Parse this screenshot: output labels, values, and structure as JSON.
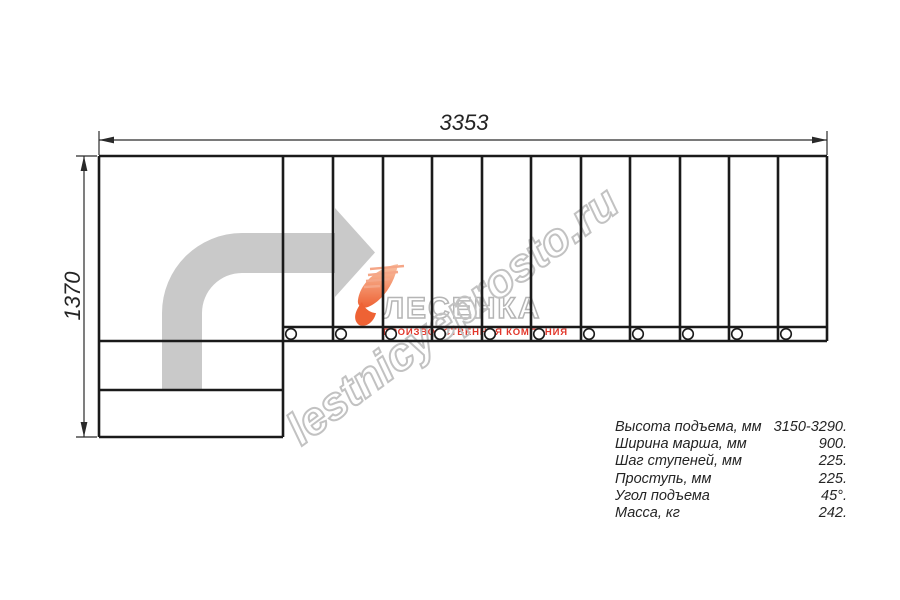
{
  "dimensions": {
    "top_label": "3353",
    "left_label": "1370"
  },
  "specs": {
    "rows": [
      {
        "label": "Высота подъема, мм",
        "value": "3150-3290."
      },
      {
        "label": "Ширина марша, мм",
        "value": "900."
      },
      {
        "label": "Шаг ступеней, мм",
        "value": "225."
      },
      {
        "label": "Проступь, мм",
        "value": "225."
      },
      {
        "label": "Угол подъема",
        "value": "45°."
      },
      {
        "label": "Масса, кг",
        "value": "242."
      }
    ]
  },
  "watermark": {
    "site": "lestnicyeprosto.ru",
    "brand": "ЛЕСЕНКА",
    "brand_sub": "ПРОИЗВОДСТВЕННАЯ КОМПАНИЯ"
  },
  "colors": {
    "bg": "#ffffff",
    "line": "#1a1a1a",
    "dim": "#2a2a2a",
    "text": "#242424",
    "arrow-gray": "#c9c9c9",
    "wm-outline": "#c2c2c2",
    "brand-outline": "#b5b5b5",
    "brand-red": "#e2372b",
    "orange-light": "#f9c3a4",
    "orange": "#ee6234",
    "orange-line": "#f5a687"
  }
}
